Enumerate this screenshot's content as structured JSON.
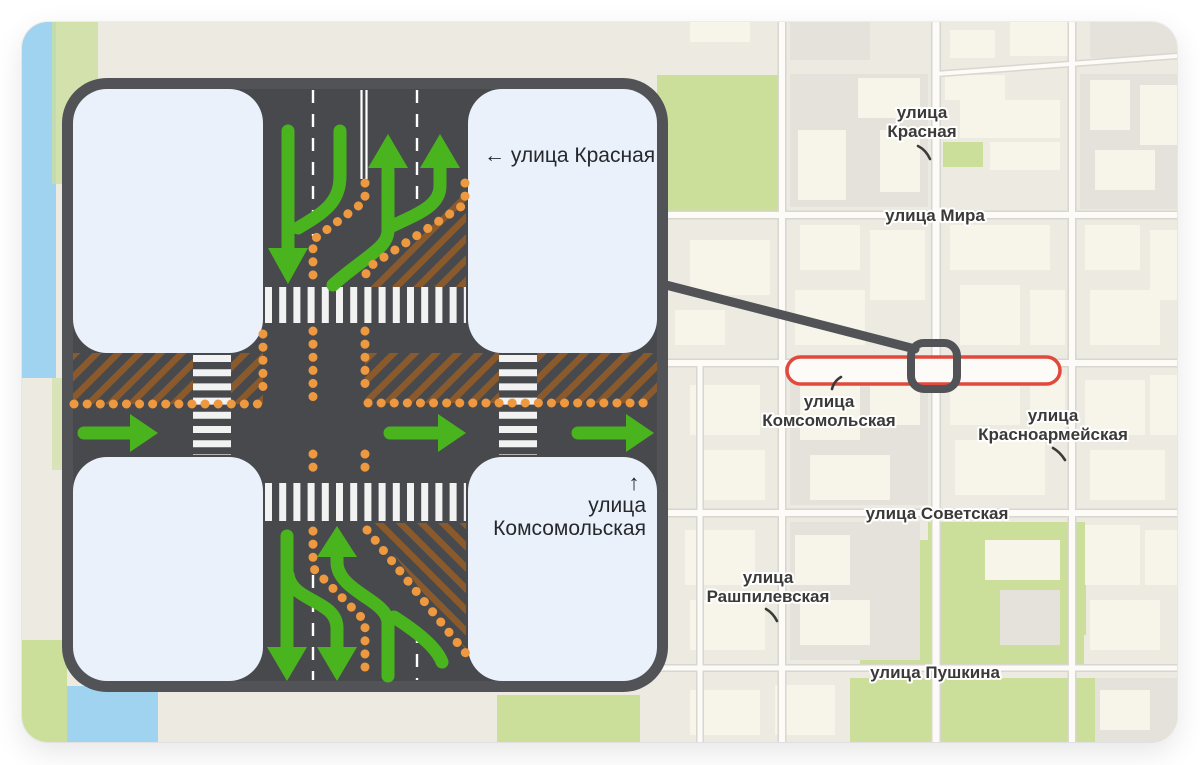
{
  "colors": {
    "map_bg": "#eceae1",
    "block_gray": "#e4e2da",
    "building_cream": "#f7f5e9",
    "park_green": "#cbdf9b",
    "water_blue": "#9fd3f0",
    "street_fill": "#fcfbf8",
    "street_casing": "#d8d6cf",
    "road_dark": "#47494c",
    "frame_gray": "#515356",
    "inset_block": "#eaf1fb",
    "arrow_green": "#4ab41f",
    "dot_orange": "#ee9840",
    "hatch_brown": "#8a5a2d",
    "crosswalk_white": "#f2f2f2",
    "route_red": "#e2493c",
    "label_dark": "#3b3a38",
    "inset_label": "#26282c"
  },
  "map": {
    "labels": [
      {
        "name": "krasnaya",
        "lines": [
          "улица",
          "Красная"
        ]
      },
      {
        "name": "mira",
        "lines": [
          "улица Мира"
        ]
      },
      {
        "name": "komsomolskaya",
        "lines": [
          "улица",
          "Комсомольская"
        ]
      },
      {
        "name": "krasnoarmeyskaya",
        "lines": [
          "улица",
          "Красноармейская"
        ]
      },
      {
        "name": "sovetskaya",
        "lines": [
          "улица Советская"
        ]
      },
      {
        "name": "rashpilevskaya",
        "lines": [
          "улица",
          "Рашпилевская"
        ]
      },
      {
        "name": "pushkina",
        "lines": [
          "улица Пушкина"
        ]
      }
    ]
  },
  "inset": {
    "street_left_label": "← улица Красная",
    "street_bottom_arrow": "↑",
    "street_bottom_line1": "улица",
    "street_bottom_line2": "Комсомольская"
  }
}
